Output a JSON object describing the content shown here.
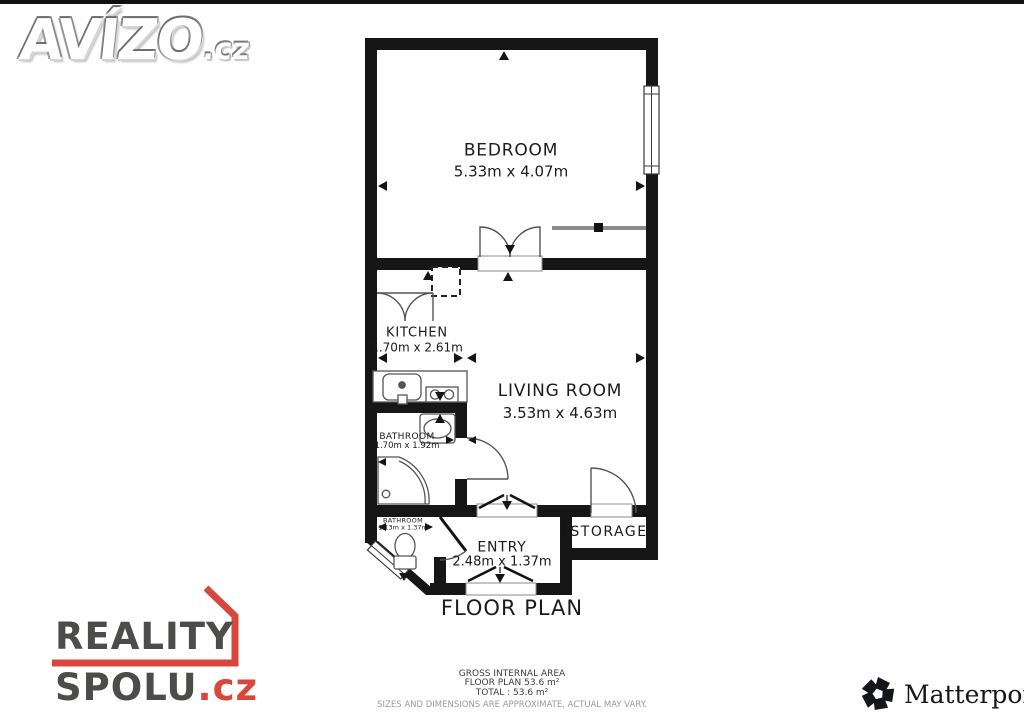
{
  "watermarks": {
    "avizo": {
      "name": "AVÍZO",
      "suffix": ".cz"
    },
    "reality_spolu": {
      "line1": "REALITY",
      "line2": "SPOLU",
      "suffix": ".cz"
    },
    "matterport": {
      "name": "Matterport",
      "mark": "®"
    }
  },
  "floor_plan": {
    "title": "FLOOR PLAN",
    "rooms": [
      {
        "name": "BEDROOM",
        "dims": "5.33m x 4.07m"
      },
      {
        "name": "KITCHEN",
        "dims": "1.70m x 2.61m"
      },
      {
        "name": "LIVING ROOM",
        "dims": "3.53m x 4.63m"
      },
      {
        "name": "BATHROOM",
        "dims": "1.70m x 1.92m"
      },
      {
        "name": "BATHROOM",
        "dims": "1.13m x 1.37m"
      },
      {
        "name": "ENTRY",
        "dims": "2.48m x 1.37m"
      },
      {
        "name": "STORAGE",
        "dims": ""
      }
    ],
    "footer": {
      "line1": "GROSS INTERNAL AREA",
      "line2": "FLOOR PLAN 53.6 m²",
      "line3": "TOTAL :  53.6 m²",
      "line4": "SIZES AND DIMENSIONS ARE APPROXIMATE, ACTUAL MAY VARY."
    }
  },
  "colors": {
    "wall": "#161616",
    "accent_red": "#d8473c",
    "logo_gray": "#4c4c4b"
  }
}
